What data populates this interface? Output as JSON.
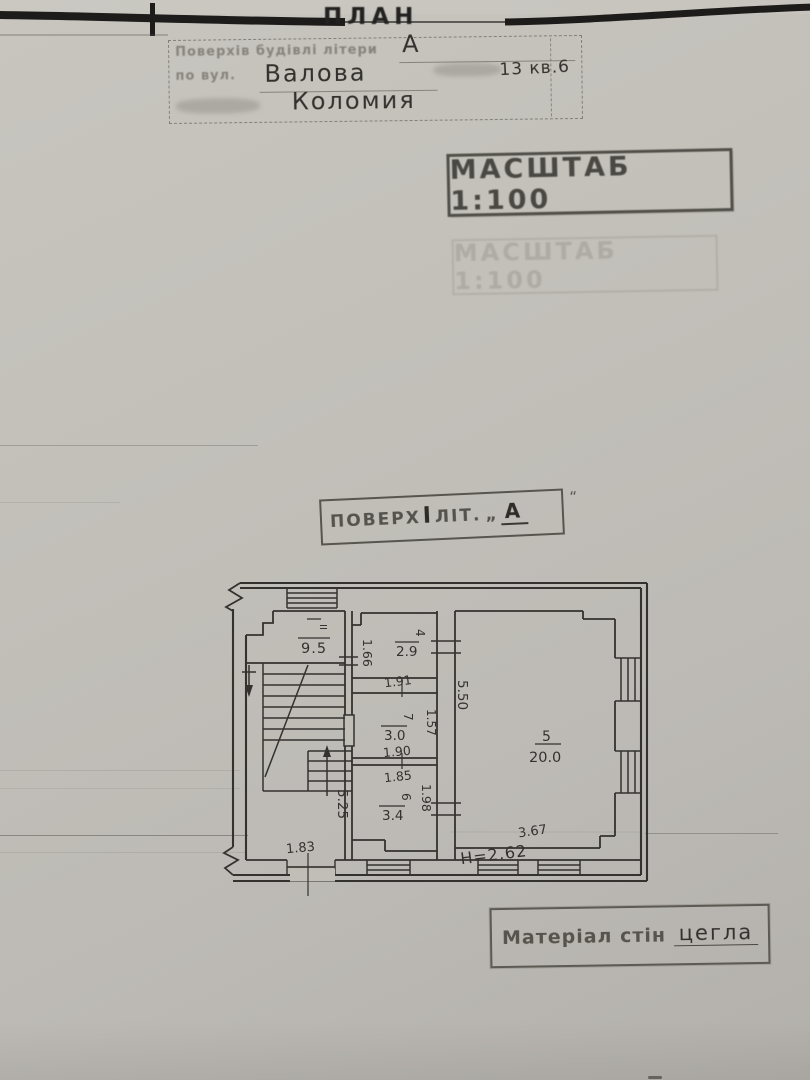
{
  "colors": {
    "paper": "#c1beb8",
    "drawing_ink": "#34322f",
    "stamp_ink": "#55534d",
    "scan_edge": "#1d1c1a"
  },
  "header": {
    "plan_title": "ПЛАН",
    "stamp_box": {
      "line1_label": "Поверхів будівлі літери",
      "line1_value": "А",
      "line2_label": "по вул.",
      "line2_street": "Валова",
      "line2_number": "13 кв.6",
      "line3_city": "Коломия"
    },
    "scale_stamp": "МАСШТАБ 1:100",
    "scale_stamp_ghost": "МАСШТАБ 1:100"
  },
  "floor_stamp": {
    "prefix": "ПОВЕРХ",
    "floor": "І",
    "lit": "ЛІТ.",
    "quote_open": "„",
    "letter": "А",
    "quote_close": "“"
  },
  "material_stamp": {
    "label": "Матеріал стін",
    "value": "цегла"
  },
  "plan": {
    "rooms": [
      {
        "id": "stair-hall",
        "number": "ІІ",
        "area": "9.5"
      },
      {
        "id": "room-4",
        "number": "4",
        "area": "2.9"
      },
      {
        "id": "room-7",
        "number": "7",
        "area": "3.0"
      },
      {
        "id": "room-6",
        "number": "6",
        "area": "3.4"
      },
      {
        "id": "room-5",
        "number": "5",
        "area": "20.0"
      }
    ],
    "dims": {
      "w166": "1.66",
      "w191": "1.91",
      "w157": "1.57",
      "w190": "1.90",
      "w185": "1.85",
      "w198": "1.98",
      "h550": "5.50",
      "h525": "5.25",
      "w183": "1.83",
      "w367": "3.67",
      "height_note": "H=2.62"
    }
  }
}
